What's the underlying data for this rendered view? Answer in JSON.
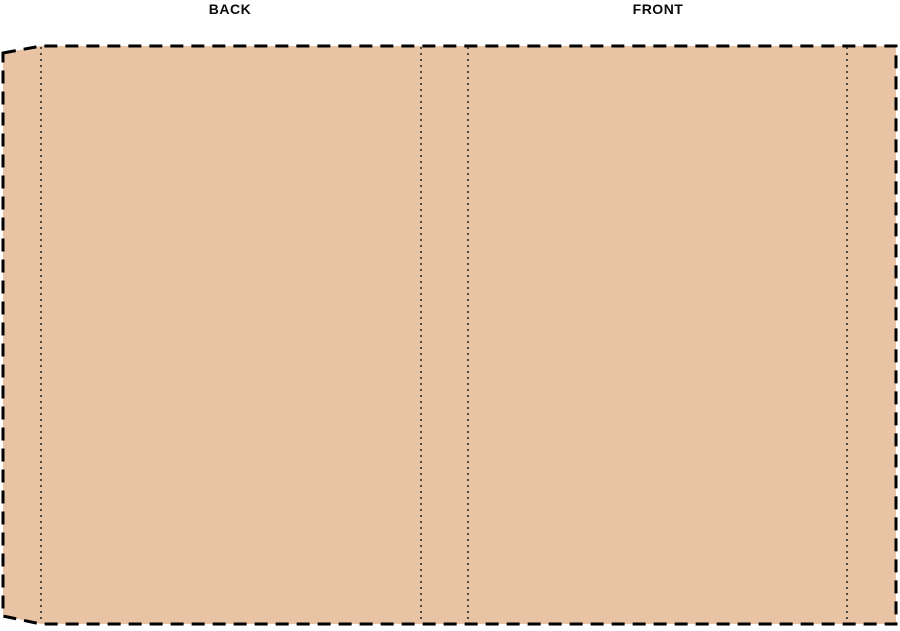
{
  "labels": {
    "back": "BACK",
    "front": "FRONT"
  },
  "colors": {
    "background": "#ffffff",
    "cover_fill": "#e8c4a4",
    "cut_line": "#000000",
    "fold_line": "#1f1f1f"
  },
  "lines": {
    "cut_line_style": "dashed",
    "fold_line_style": "dotted",
    "fold_line_count": 4
  }
}
